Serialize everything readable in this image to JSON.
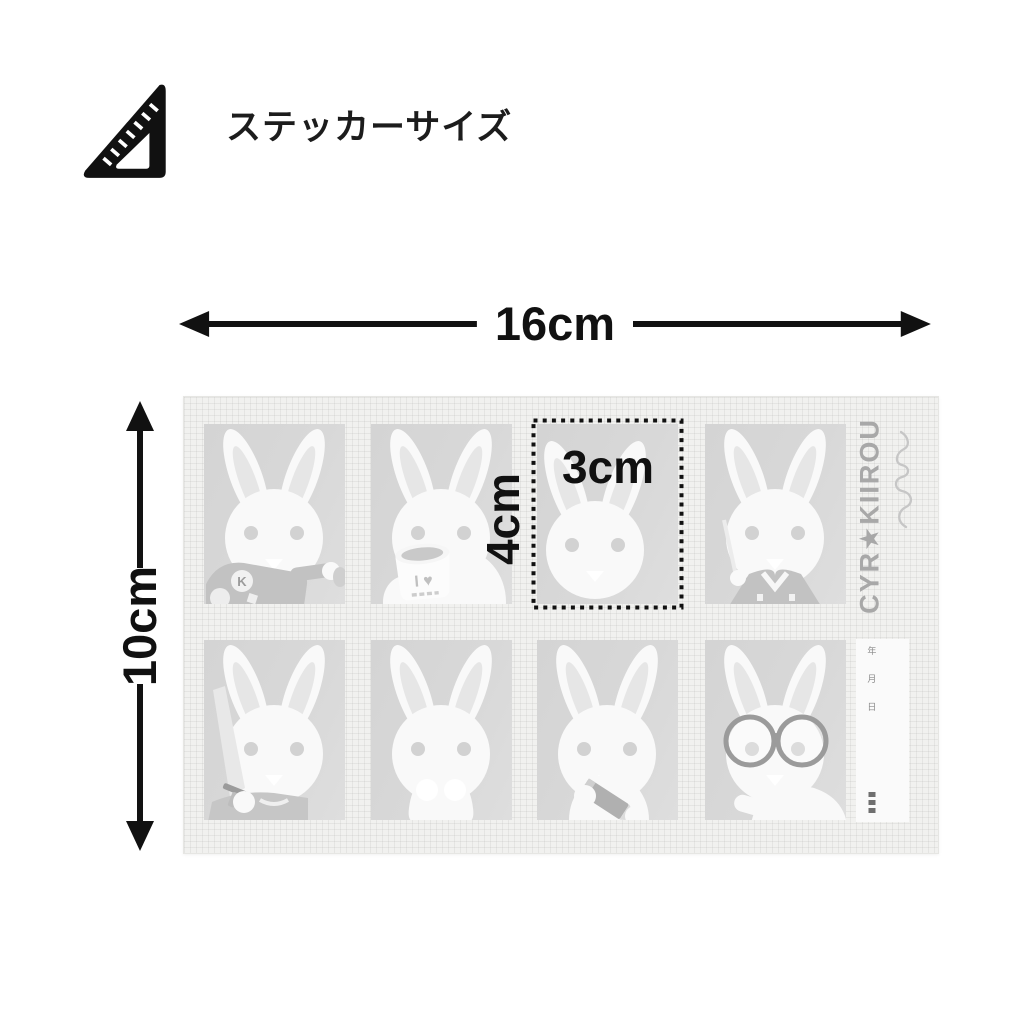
{
  "header": {
    "title": "ステッカーサイズ",
    "icon": "triangle-ruler"
  },
  "dimensions": {
    "width_label": "16cm",
    "height_label": "10cm",
    "sticker_width_label": "3cm",
    "sticker_height_label": "4cm"
  },
  "sheet": {
    "brand": "CYR★KIIROU",
    "signature_script": "yuyu",
    "rows": 2,
    "cols": 4,
    "stickers": [
      {
        "variant": "jacket-k",
        "name": "rabbit-with-k-jacket",
        "badge_letter": "K"
      },
      {
        "variant": "mug",
        "name": "rabbit-with-mug",
        "mug_text": "I ♥"
      },
      {
        "variant": "plain-offset",
        "name": "rabbit-plain-highlighted",
        "highlighted": true
      },
      {
        "variant": "kimono",
        "name": "rabbit-in-kimono"
      },
      {
        "variant": "sword",
        "name": "rabbit-with-sword"
      },
      {
        "variant": "body",
        "name": "rabbit-full-body"
      },
      {
        "variant": "pencil",
        "name": "rabbit-with-pencil"
      },
      {
        "variant": "glasses",
        "name": "rabbit-with-glasses"
      }
    ],
    "date_strip": {
      "chars": [
        "年",
        "月",
        "日"
      ],
      "footer_blocks": 3
    }
  },
  "palette": {
    "ink": "#111111",
    "sheet_bg": "#f1f1ef",
    "sticker_bg": "#d7d7d7",
    "rabbit": "#f9f9f9",
    "inner_ear": "#e6e6e6",
    "eye": "#d2d2d2",
    "accessory": "#c2c2c2",
    "accessory_dark": "#9b9b9b",
    "brand": "#a8a8a8",
    "signature": "#c6c6c6",
    "strip_bg": "#fafafa",
    "strip_text": "#8a8a8a"
  }
}
